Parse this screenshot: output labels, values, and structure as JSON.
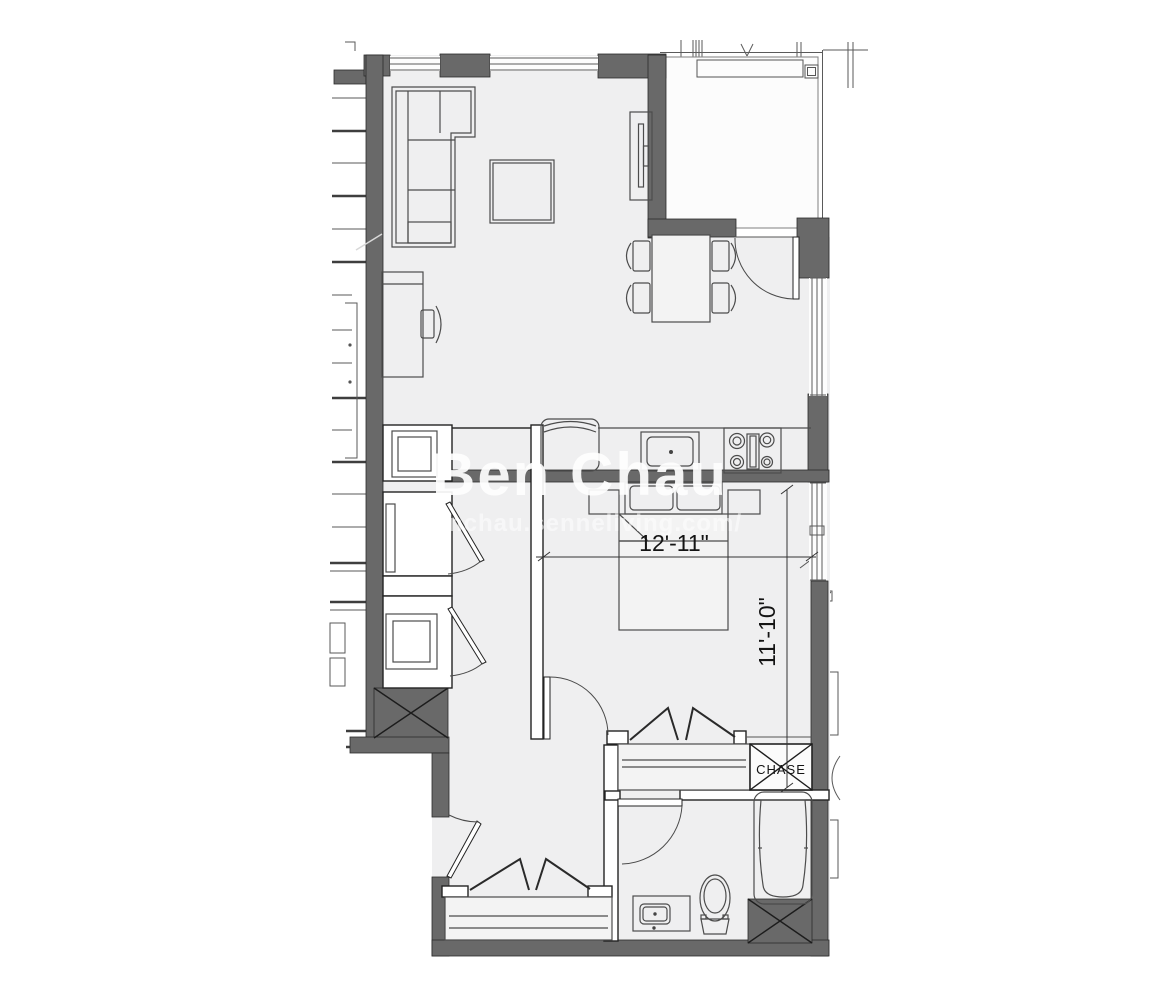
{
  "plan": {
    "watermark": {
      "name": "Ben Chau",
      "url": "benchau.senneliving.com/"
    },
    "labels": {
      "chase": "CHASE"
    },
    "dimensions": {
      "bedroom_width": "12'-11\"",
      "bedroom_depth": "11'-10\""
    },
    "colors": {
      "background": "#ffffff",
      "floor": "#efeff0",
      "wall": "#696969",
      "watermark": "#ffffff"
    }
  }
}
